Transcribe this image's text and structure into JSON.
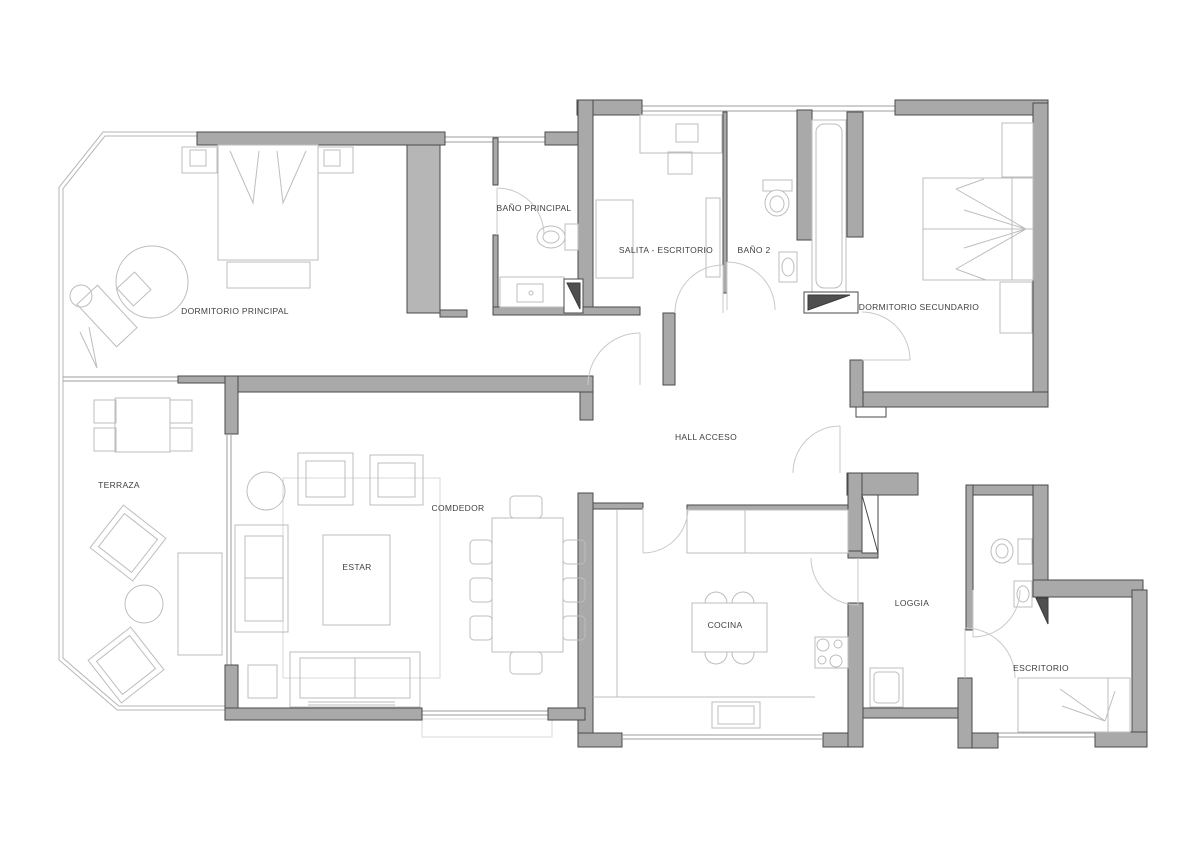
{
  "rooms": [
    {
      "id": "dormitorio-principal",
      "label": "DORMITORIO PRINCIPAL"
    },
    {
      "id": "bano-principal",
      "label": "BAÑO PRINCIPAL"
    },
    {
      "id": "salita-escritorio",
      "label": "SALITA - ESCRITORIO"
    },
    {
      "id": "bano-2",
      "label": "BAÑO 2"
    },
    {
      "id": "dormitorio-secundario",
      "label": "DORMITORIO SECUNDARIO"
    },
    {
      "id": "hall-acceso",
      "label": "HALL ACCESO"
    },
    {
      "id": "terraza",
      "label": "TERRAZA"
    },
    {
      "id": "estar",
      "label": "ESTAR"
    },
    {
      "id": "comdedor",
      "label": "COMDEDOR"
    },
    {
      "id": "cocina",
      "label": "COCINA"
    },
    {
      "id": "loggia",
      "label": "LOGGIA"
    },
    {
      "id": "escritorio",
      "label": "ESCRITORIO"
    }
  ],
  "palette": {
    "background": "#ffffff",
    "wall_fill": "#a9a9a9",
    "wall_stroke": "#4a4a4a",
    "furniture_line": "#bdbdbd",
    "window_line": "#9c9c9c",
    "door_line": "#c9c9c9",
    "dark_fill": "#4f4f4f",
    "label_color": "#3f3f3f"
  }
}
